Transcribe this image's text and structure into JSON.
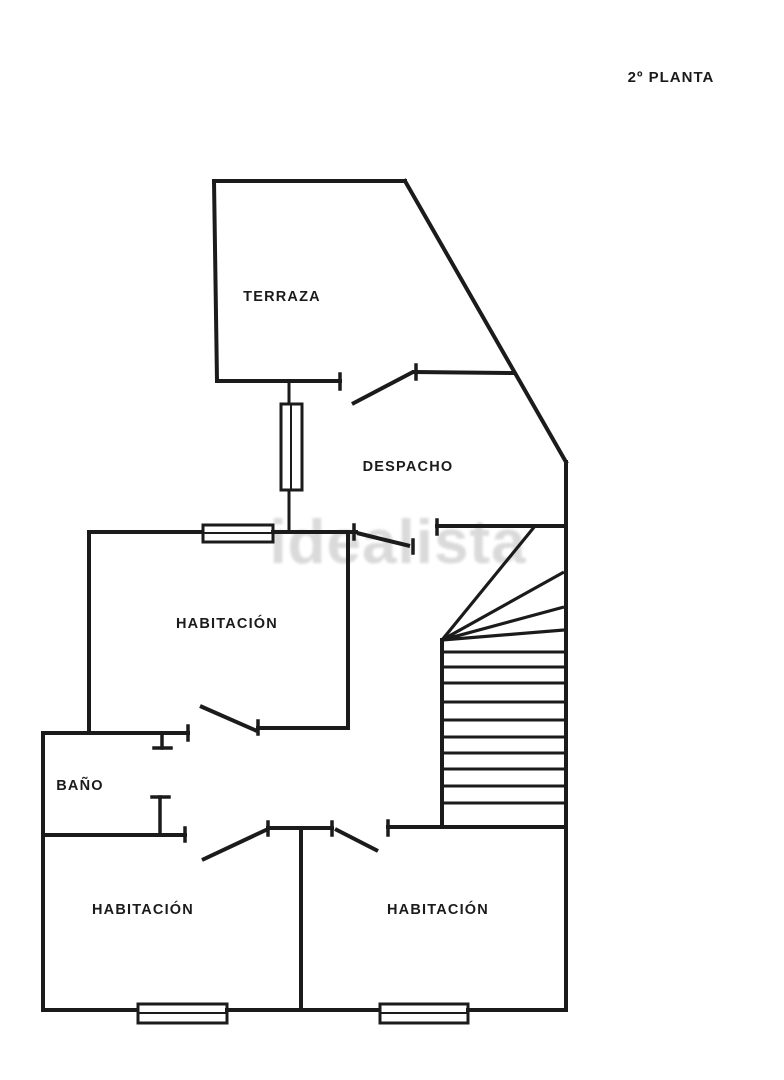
{
  "title": {
    "text": "2º PLANTA"
  },
  "watermark": {
    "text": "idealista"
  },
  "palette": {
    "ink": "#1b1b1b",
    "background": "#ffffff",
    "watermark_gray": "#c2c2c2"
  },
  "rooms": {
    "terraza": {
      "label": "TERRAZA"
    },
    "despacho": {
      "label": "DESPACHO"
    },
    "habitacion_media": {
      "label": "HABITACIÓN"
    },
    "bano": {
      "label": "BAÑO"
    },
    "habitacion_izquierda": {
      "label": "HABITACIÓN"
    },
    "habitacion_derecha": {
      "label": "HABITACIÓN"
    }
  }
}
